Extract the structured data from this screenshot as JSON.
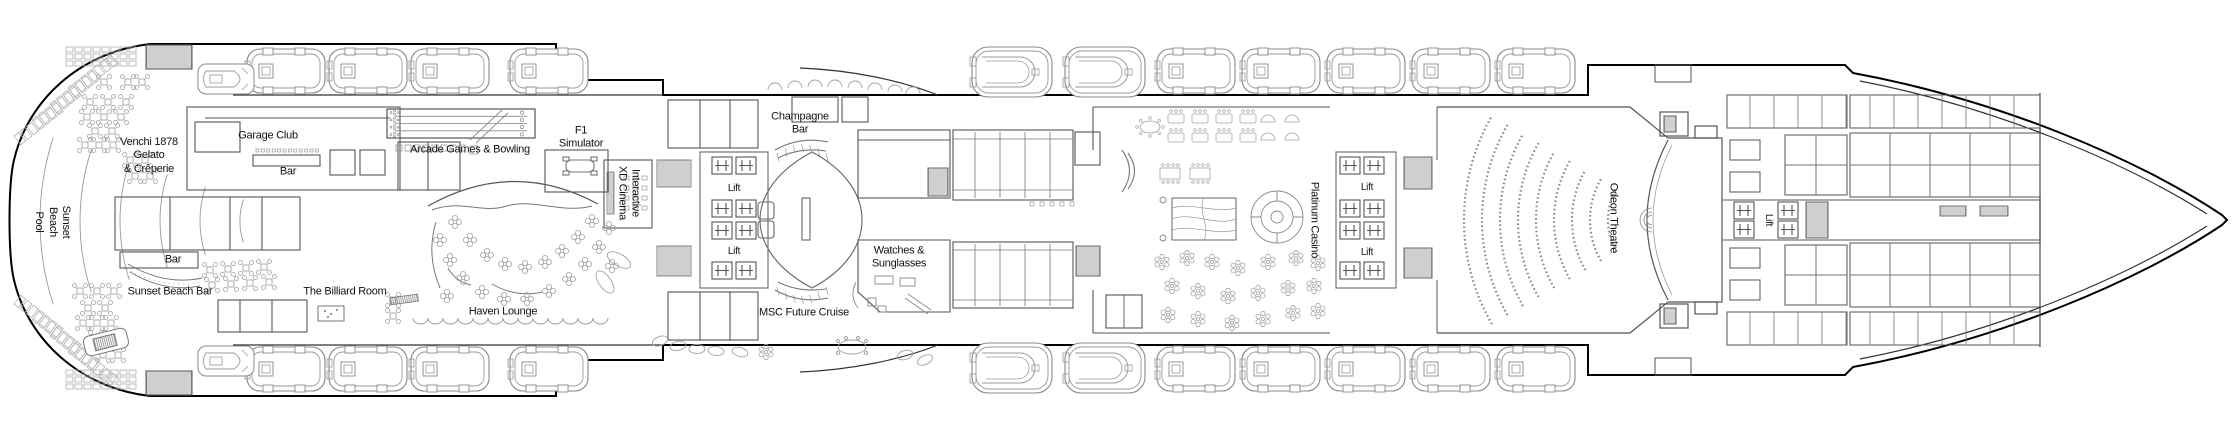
{
  "deck_plan": {
    "description": "Cruise ship deck plan with public venues, lifts, lifeboats and theatre",
    "colors": {
      "background": "#ffffff",
      "outline": "#000000",
      "interior": "#555555",
      "furniture": "#a3a3a3",
      "text": "#111111"
    },
    "labels": {
      "venchi": "Venchi 1878\nGelato\n& Crêperie",
      "garage_club": "Garage Club",
      "garage_bar": "Bar",
      "sunset_beach_pool": "Sunset\nBeach\nPool",
      "pool_bar": "Bar",
      "sunset_beach_bar": "Sunset Beach Bar",
      "billiard_room": "The Billiard Room",
      "arcade_bowling": "Arcade Games & Bowling",
      "f1_simulator": "F1\nSimulator",
      "xd_cinema": "Interactive\nXD Cinema",
      "lift": "Lift",
      "haven_lounge": "Haven Lounge",
      "champagne_bar": "Champagne\nBar",
      "watches_sunglasses": "Watches &\nSunglasses",
      "msc_future_cruise": "MSC Future Cruise",
      "platinum_casino": "Platinum Casino",
      "odeon_theatre": "Odeon Theatre"
    }
  }
}
